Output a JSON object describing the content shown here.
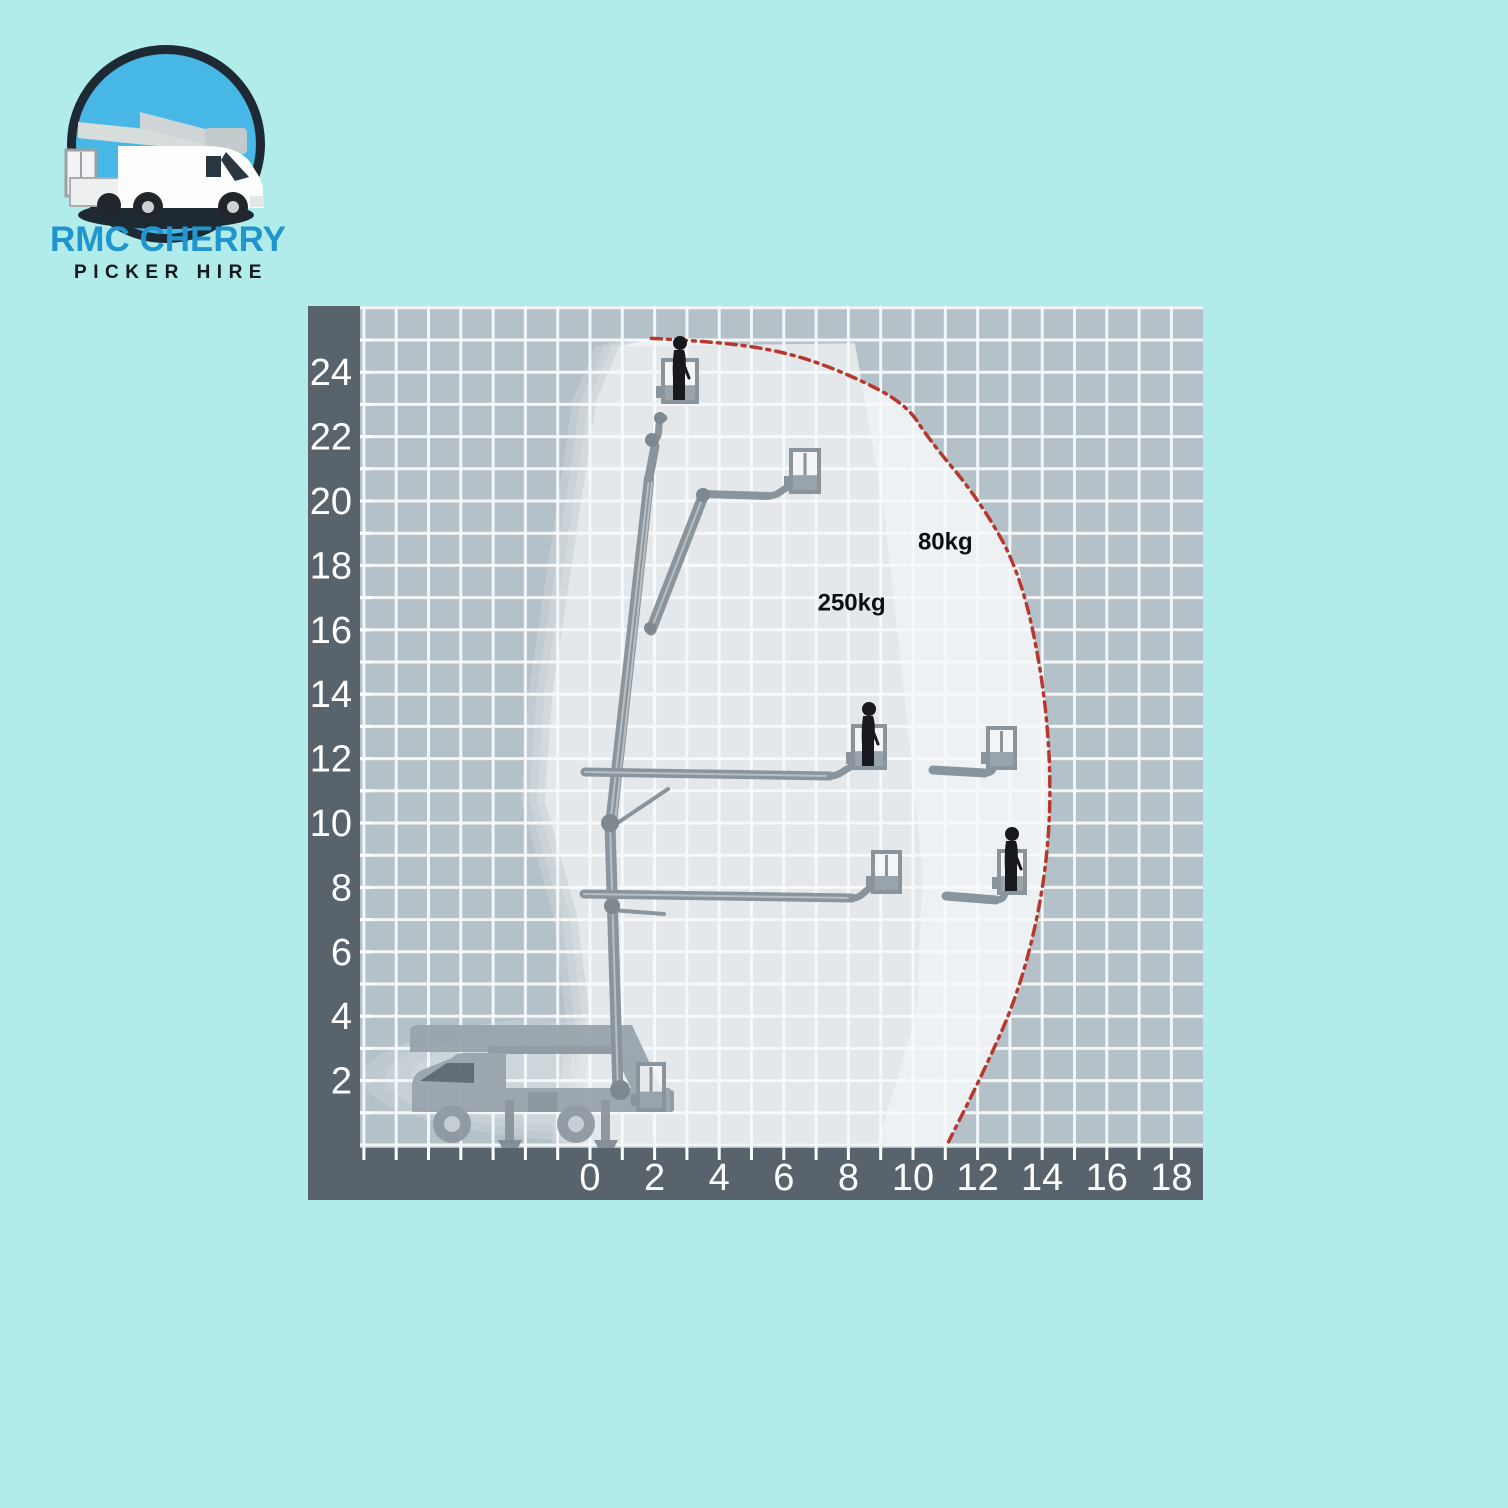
{
  "logo": {
    "brand_line1": "RMC CHERRY",
    "brand_line2": "PICKER HIRE",
    "brand_color": "#2095ce",
    "tagline_color": "#14191d"
  },
  "page": {
    "background": "#b2ecea"
  },
  "chart_data": {
    "type": "area",
    "title": "",
    "description": "Cherry picker boom lift working envelope: outreach (m) vs working height (m) with load zones",
    "x_axis": {
      "tick_labels": [
        0,
        2,
        4,
        6,
        8,
        10,
        12,
        14,
        16,
        18
      ],
      "range": [
        -7,
        19
      ],
      "minor_step": 1
    },
    "y_axis": {
      "tick_labels": [
        2,
        4,
        6,
        8,
        10,
        12,
        14,
        16,
        18,
        20,
        22,
        24
      ],
      "range": [
        0,
        26
      ],
      "minor_step": 1
    },
    "max_working_height_m": 25,
    "max_outreach_m": 14.3,
    "grid": true,
    "axis_band_color": "#59636b",
    "grid_bg_color": "#b5c1c9",
    "grid_line_color": "#f7f9fa",
    "tick_label_color": "#ffffff",
    "load_label_color": "#0d1013",
    "load_zones": [
      {
        "label": "80kg",
        "fill": "#eef1f3",
        "label_pos": {
          "x": 11.0,
          "y": 18.5
        },
        "boundary": [
          [
            0.9,
            24.8
          ],
          [
            1.9,
            25.05
          ],
          [
            4.0,
            24.95
          ],
          [
            6.2,
            24.6
          ],
          [
            8.1,
            23.9
          ],
          [
            9.8,
            23.0
          ],
          [
            10.5,
            21.9
          ],
          [
            12.0,
            20.1
          ],
          [
            13.3,
            17.85
          ],
          [
            14.05,
            14.4
          ],
          [
            14.3,
            11.0
          ],
          [
            14.05,
            7.9
          ],
          [
            13.3,
            4.8
          ],
          [
            12.2,
            2.3
          ],
          [
            11.1,
            0.05
          ],
          [
            -0.45,
            0.05
          ],
          [
            0.05,
            3.55
          ],
          [
            -0.4,
            7.15
          ],
          [
            -1.4,
            10.7
          ],
          [
            -1.15,
            14.1
          ],
          [
            0.2,
            23.1
          ]
        ]
      },
      {
        "label": "250kg",
        "fill": "#e4e8eb",
        "label_pos": {
          "x": 8.1,
          "y": 16.6
        },
        "boundary": [
          [
            0.9,
            24.8
          ],
          [
            8.2,
            24.9
          ],
          [
            9.1,
            19.7
          ],
          [
            9.75,
            13.8
          ],
          [
            10.3,
            8.5
          ],
          [
            10.1,
            4.0
          ],
          [
            8.9,
            0.05
          ],
          [
            -0.45,
            0.05
          ],
          [
            0.05,
            3.55
          ],
          [
            -0.4,
            7.15
          ],
          [
            -1.4,
            10.7
          ],
          [
            -1.15,
            14.1
          ],
          [
            0.2,
            23.1
          ]
        ]
      }
    ],
    "limit_curve": {
      "color": "#b5392e",
      "style": "dash-dot",
      "points": [
        [
          1.9,
          25.05
        ],
        [
          4.0,
          24.95
        ],
        [
          6.2,
          24.6
        ],
        [
          8.1,
          23.9
        ],
        [
          9.8,
          23.0
        ],
        [
          10.5,
          21.9
        ],
        [
          12.0,
          20.1
        ],
        [
          13.3,
          17.85
        ],
        [
          14.05,
          14.4
        ],
        [
          14.3,
          11.0
        ],
        [
          14.05,
          7.9
        ],
        [
          13.3,
          4.8
        ],
        [
          12.2,
          2.3
        ],
        [
          11.1,
          0.1
        ]
      ]
    }
  }
}
